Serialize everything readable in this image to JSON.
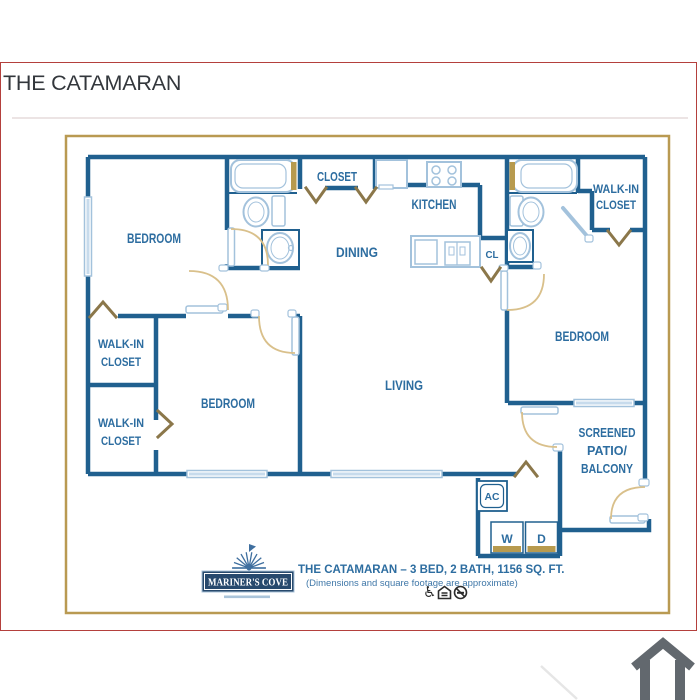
{
  "title": "THE CATAMARAN",
  "rooms": {
    "bedroom_tl": "BEDROOM",
    "closet_top": "CLOSET",
    "kitchen": "KITCHEN",
    "dining": "DINING",
    "cl": "CL",
    "walkin_tr_l1": "WALK-IN",
    "walkin_tr_l2": "CLOSET",
    "bedroom_r": "BEDROOM",
    "walkin_u_l1": "WALK-IN",
    "walkin_u_l2": "CLOSET",
    "walkin_d_l1": "WALK-IN",
    "walkin_d_l2": "CLOSET",
    "bedroom_b": "BEDROOM",
    "living": "LIVING",
    "patio_l1": "SCREENED",
    "patio_l2": "PATIO/",
    "patio_l3": "BALCONY",
    "ac": "AC",
    "washer": "W",
    "dryer": "D"
  },
  "footer": {
    "logo": "MARINER'S COVE",
    "name": "THE CATAMARAN",
    "specs": " – 3 BED, 2 BATH, 1156 SQ. FT.",
    "disclaimer": "(Dimensions and square footage are approximate)",
    "wheelchair_glyph": "♿"
  },
  "colors": {
    "wall": "#20608f",
    "label": "#2d6da0",
    "gold": "#b79a4e",
    "chevron": "#8b774a",
    "door_arc": "#d9c08b",
    "red_border": "#b4403d",
    "logo_navy": "#27496d",
    "home_icon_gray": "#62686e",
    "fixture_blue": "#a3c2dc"
  }
}
